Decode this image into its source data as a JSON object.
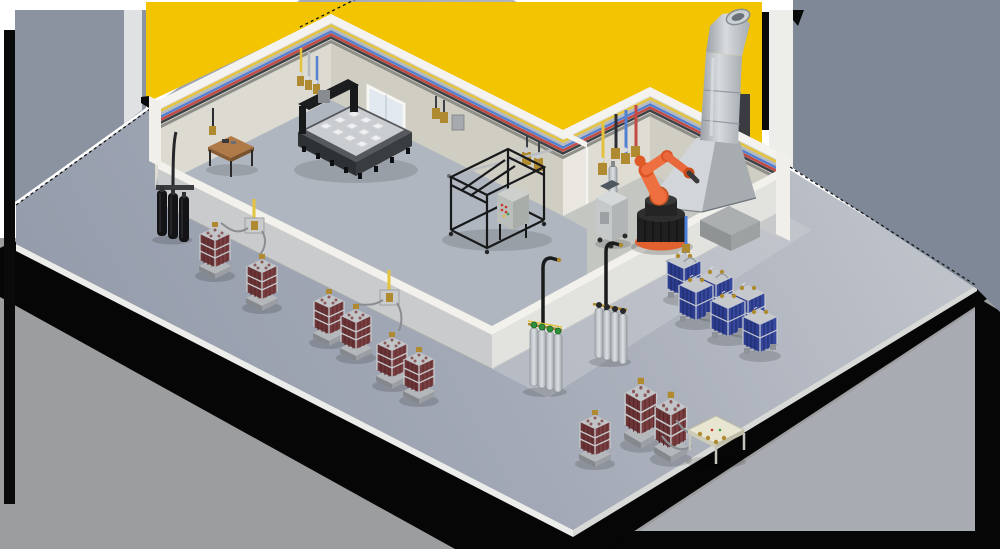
{
  "scene": {
    "kind": "isometric-cutaway-illustration",
    "subject": "industrial-gas-supply-facility",
    "palette": {
      "backdrop_yellow": "#F2C402",
      "backdrop_gray_left": "#8B93A1",
      "backdrop_gray_right": "#7F8897",
      "bottom_background": "#9C9D9F",
      "lower_slab_gray": "#A9ABB3",
      "shadow_black": "#060606",
      "wall_cap_white": "#F4F3EF",
      "wall_nw_face": "#DDDAD2",
      "wall_ne_face": "#D0CDC3",
      "divider_face": "#E9E7DF",
      "floor_main_room": "#AFB6BF",
      "floor_robot_room": "#C4C6C2",
      "apron_wall_sw": "#C9CBCC",
      "apron_wall_se": "#E2E3DF",
      "pipe_yellow": "#E3C23C",
      "pipe_silver": "#B4BAC0",
      "pipe_blue": "#5380D0",
      "pipe_red": "#C24A42",
      "pipe_charcoal": "#3C4146",
      "drop_blue": "#4C7FD8",
      "robot_orange": "#E8683C",
      "robot_orange_dark": "#DD5526",
      "cylinder_maroon": "#6B3537",
      "cylinder_blue_pack": "#2C3C8E",
      "cylinder_black": "#141416",
      "cylinder_silver": "#C6CACE",
      "cap_green": "#2F8F3C",
      "brass": "#B08A30",
      "steel_light": "#D2D6DA",
      "steel_dark": "#9FA5AB",
      "hose_gray": "#8A8E92",
      "bench_wood": "#B07A48"
    },
    "pipelines": {
      "ring_colors_top_to_bottom": [
        "#E3C23C",
        "#B4BAC0",
        "#5380D0",
        "#C24A42",
        "#3C4146"
      ],
      "drop_colors": [
        "yellow",
        "silver",
        "blue",
        "red",
        "black"
      ]
    },
    "rooms": [
      {
        "id": "main-production-room"
      },
      {
        "id": "robot-cell"
      }
    ],
    "equipment": [
      {
        "id": "wall-mounted-cylinder-rack-black",
        "area": "southwest-apron"
      },
      {
        "id": "cylinder-bundle-1",
        "area": "southwest-apron"
      },
      {
        "id": "cylinder-bundle-2",
        "area": "southwest-apron"
      },
      {
        "id": "cylinder-bundle-3",
        "area": "southwest-apron"
      },
      {
        "id": "cylinder-bundle-4",
        "area": "southwest-apron"
      },
      {
        "id": "cylinder-bundle-5",
        "area": "southwest-apron"
      },
      {
        "id": "cylinder-bundle-6",
        "area": "southwest-apron"
      },
      {
        "id": "wall-manifold-plate-1",
        "area": "southwest-wall"
      },
      {
        "id": "wall-manifold-plate-2",
        "area": "southwest-wall"
      },
      {
        "id": "gantry-machine",
        "area": "main-production-room"
      },
      {
        "id": "workbench",
        "area": "main-production-room"
      },
      {
        "id": "frame-machine-with-control-cabinet",
        "area": "main-production-room"
      },
      {
        "id": "wall-tapping-points",
        "area": "main-room-walls"
      },
      {
        "id": "window",
        "area": "northeast-wall"
      },
      {
        "id": "robot-arm",
        "area": "robot-cell"
      },
      {
        "id": "robot-pedestal",
        "area": "robot-cell"
      },
      {
        "id": "equipment-plinth",
        "area": "robot-cell"
      },
      {
        "id": "mobile-control-cart",
        "area": "robot-cell"
      },
      {
        "id": "fume-extraction-hood",
        "area": "robot-cell"
      },
      {
        "id": "gas-drop-station",
        "area": "robot-cell-wall"
      },
      {
        "id": "silver-cylinder-rack-green-caps",
        "area": "southeast-apron"
      },
      {
        "id": "silver-cylinder-rack-dark-caps",
        "area": "southeast-apron"
      },
      {
        "id": "blue-cylinder-pack-group",
        "count": 6,
        "area": "southeast-apron"
      },
      {
        "id": "cylinder-bundle-7",
        "area": "southeast-apron"
      },
      {
        "id": "tall-cylinder-pack-1",
        "area": "southeast-apron"
      },
      {
        "id": "tall-cylinder-pack-2",
        "area": "southeast-apron"
      },
      {
        "id": "manifold-bench",
        "area": "southeast-apron"
      }
    ]
  }
}
